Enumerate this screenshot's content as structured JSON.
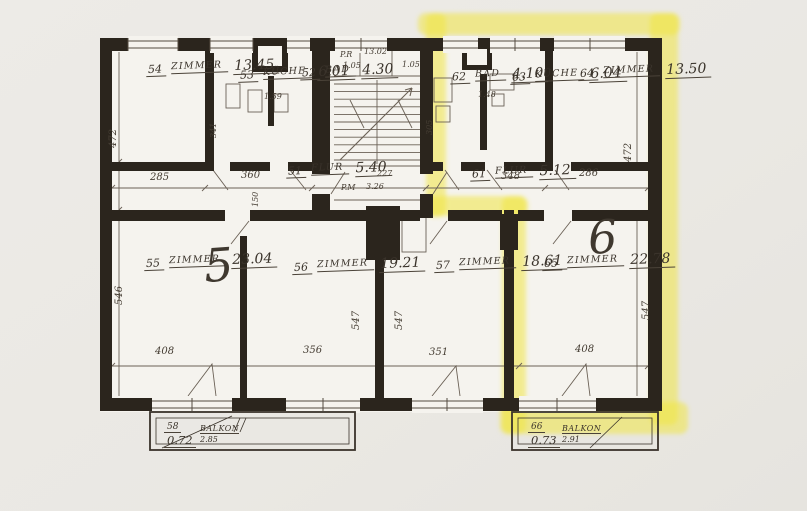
{
  "plan_title": "apartment-floor-plan",
  "colors": {
    "highlight": "#f0e542",
    "ink": "#2b251d",
    "paper": "#f5f3ee"
  },
  "units": {
    "five": "5",
    "six": "6"
  },
  "rooms": {
    "r54": {
      "num": "54",
      "name": "ZIMMER",
      "area": "13.45"
    },
    "r53": {
      "num": "53",
      "name": "KÜCHE",
      "area": "6.01"
    },
    "r52": {
      "num": "52",
      "name": "BAD",
      "area": "4.30"
    },
    "r62": {
      "num": "62",
      "name": "BAD",
      "area": "4.10"
    },
    "r63": {
      "num": "63",
      "name": "KÜCHE",
      "area": "6.04"
    },
    "r64": {
      "num": "64",
      "name": "ZIMMER",
      "area": "13.50"
    },
    "r51": {
      "num": "51",
      "name": "FLUR",
      "area": "5.40"
    },
    "r61": {
      "num": "61",
      "name": "FLUR",
      "area": "5.12"
    },
    "r55": {
      "num": "55",
      "name": "ZIMMER",
      "area": "23.04"
    },
    "r56": {
      "num": "56",
      "name": "ZIMMER",
      "area": "19.21"
    },
    "r57": {
      "num": "57",
      "name": "ZIMMER",
      "area": "18.61"
    },
    "r65": {
      "num": "65",
      "name": "ZIMMER",
      "area": "22.78"
    },
    "b58": {
      "num": "58",
      "name": "BALKON",
      "area": "0.72",
      "width": "2.85"
    },
    "b66": {
      "num": "66",
      "name": "BALKON",
      "area": "0.73",
      "width": "2.91"
    }
  },
  "stairwell": {
    "top_left": "P.R",
    "top_left_val": "1.05",
    "top_center": "13.02",
    "top_right_val": "1.05",
    "landing": "P.M",
    "landing_area": "3.26",
    "landing_width": "227"
  },
  "dims": {
    "w285": "285",
    "w360": "360",
    "w348": "348",
    "w286": "286",
    "w408a": "408",
    "w356": "356",
    "w351": "351",
    "w408b": "408",
    "h472l": "472",
    "h546": "546",
    "h341": "341",
    "h305": "305",
    "h547a": "547",
    "h547b": "547",
    "h472r": "472",
    "h547c": "547",
    "h150": "150",
    "s159": "1.59",
    "s148": "1.48"
  }
}
